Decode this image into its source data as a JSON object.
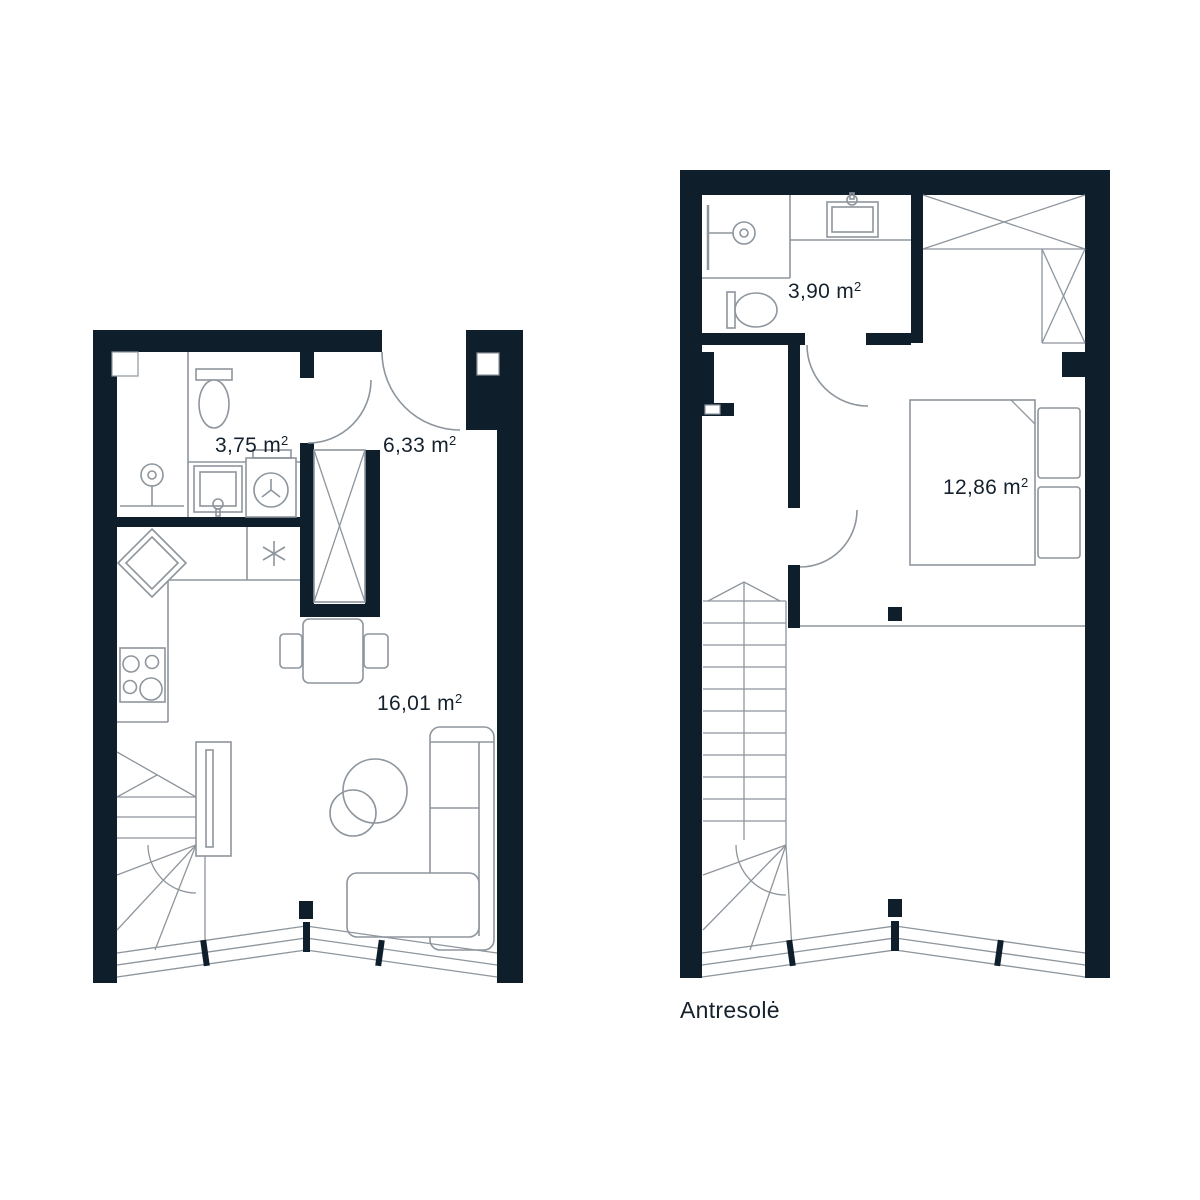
{
  "colors": {
    "wall": "#0f1e2b",
    "line": "#8d959d",
    "text": "#15222e",
    "background": "#ffffff"
  },
  "ground_floor": {
    "rooms": {
      "bathroom": {
        "area_label": "3,75 m",
        "area_sup": "2"
      },
      "hallway": {
        "area_label": "6,33 m",
        "area_sup": "2"
      },
      "living_room": {
        "area_label": "16,01 m",
        "area_sup": "2"
      }
    }
  },
  "mezzanine": {
    "title": "Antresolė",
    "rooms": {
      "bathroom": {
        "area_label": "3,90 m",
        "area_sup": "2"
      },
      "bedroom": {
        "area_label": "12,86 m",
        "area_sup": "2"
      }
    }
  }
}
